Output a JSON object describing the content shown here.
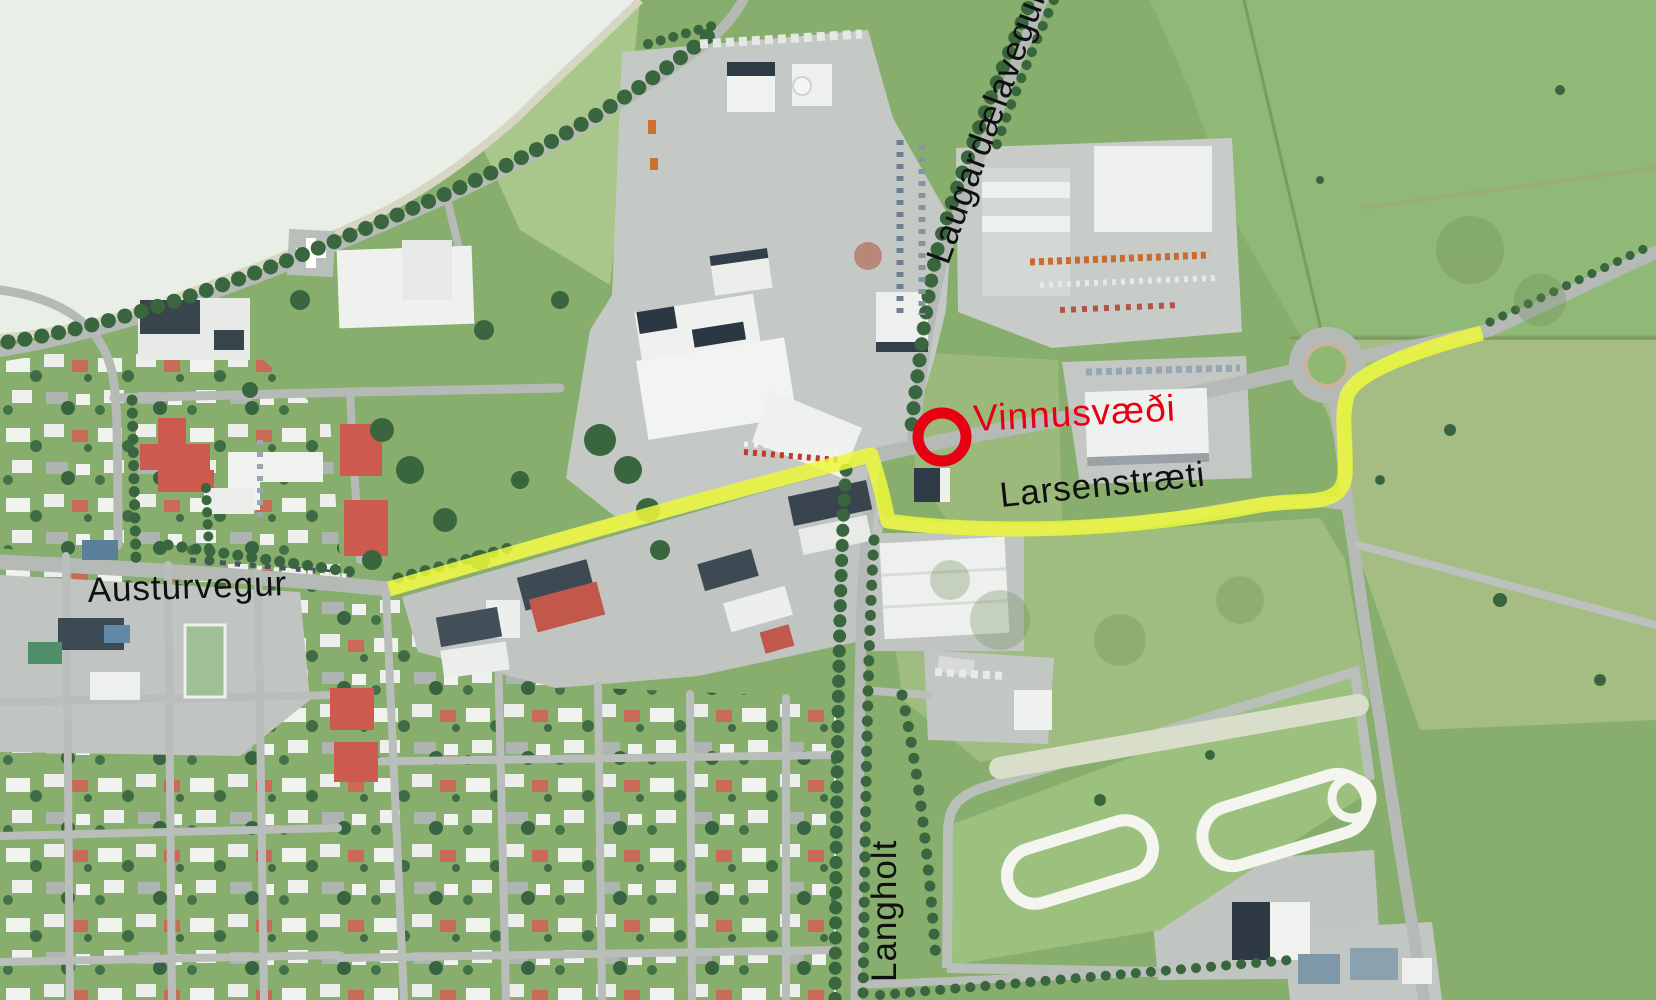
{
  "labels": {
    "laugardalavegur": {
      "text": "Laugardælavegur",
      "color": "#101010"
    },
    "vinnusvaedi": {
      "text": "Vinnusvæði",
      "color": "#e60012"
    },
    "larsenstraeti": {
      "text": "Larsenstræti",
      "color": "#101010"
    },
    "austurvegur": {
      "text": "Austurvegur",
      "color": "#101010"
    },
    "langholt": {
      "text": "Langholt",
      "color": "#101010"
    }
  },
  "annotations": {
    "route_color": "#edf93a",
    "route_opacity": "0.85",
    "marker_color": "#e60012",
    "marker_shape": "circle-outline"
  }
}
